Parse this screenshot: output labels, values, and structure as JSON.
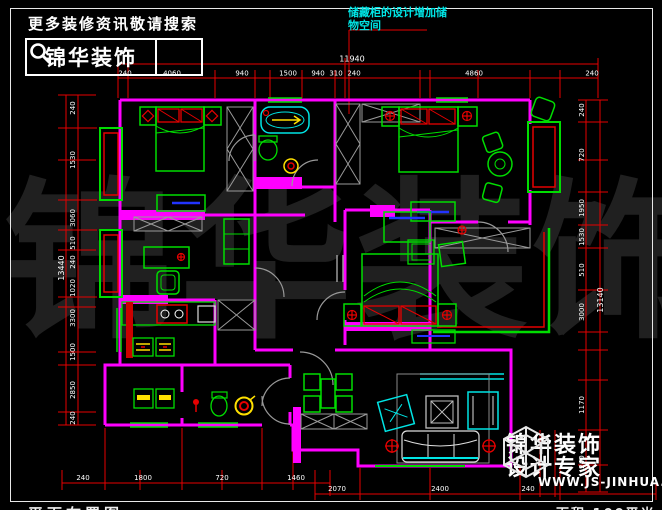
{
  "header": {
    "search_hint": "更多装修资讯敬请搜索",
    "brand": "锦华装饰"
  },
  "note": {
    "line1": "储藏柜的设计增加储",
    "line2": "物空间"
  },
  "watermark": "锦华装饰",
  "logo": {
    "brand": "锦华装饰",
    "tagline": "设计专家",
    "website": "WWW.JS-JINHUA.COM"
  },
  "titleblock": {
    "drawing_title": "平面布置图",
    "area": "面积 100平米"
  },
  "dims": {
    "top": {
      "total": "11940",
      "segments": [
        "240",
        "4060",
        "940",
        "1500",
        "940",
        "310",
        "240",
        "4860",
        "240"
      ]
    },
    "left": {
      "total": "13440",
      "segments": [
        "240",
        "1530",
        "3060",
        "510",
        "240",
        "1020",
        "3300",
        "1500",
        "2850",
        "240"
      ]
    },
    "right": {
      "total": "13140",
      "segments": [
        "240",
        "720",
        "1950",
        "1530",
        "510",
        "3000",
        "1170",
        "240"
      ]
    },
    "bottom_left": {
      "segments": [
        "240",
        "1800",
        "720",
        "1460"
      ]
    },
    "bottom_right": {
      "segments": [
        "2070",
        "2400",
        "240"
      ]
    }
  },
  "colors": {
    "wall": "#FF00FF",
    "furniture": "#00DD00",
    "dimension": "#E60000",
    "fixture": "#00E5E5",
    "hatch": "#9A9A9A",
    "accent_yellow": "#FFE000",
    "accent_blue": "#2233FF",
    "text": "#FFFFFF",
    "watermark": "#202020",
    "note": "#00E5E5"
  }
}
